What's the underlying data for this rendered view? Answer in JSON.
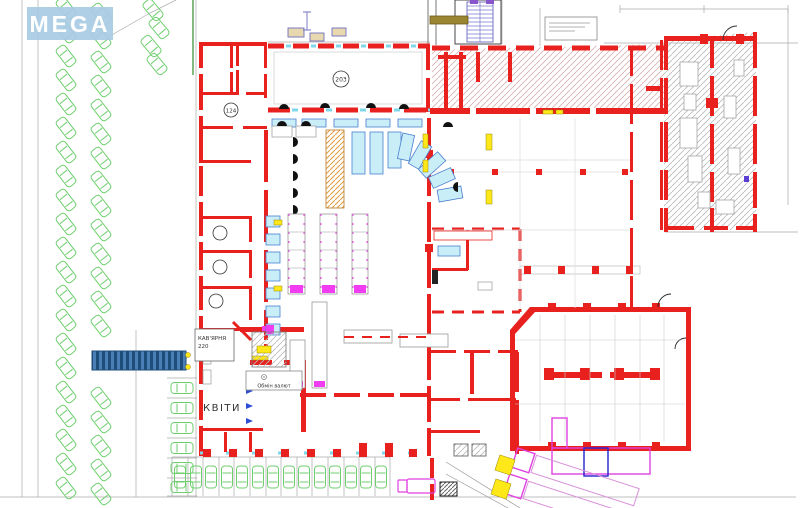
{
  "watermark": {
    "text": "MEGA"
  },
  "labels": {
    "hall_number": "203",
    "room_number": "124",
    "cafe_line1": "КАВ'ЯРНЯ",
    "cafe_line2": "220",
    "flowers": "КВІТИ",
    "currency_exchange": "Обмін валют"
  },
  "colors": {
    "wall_red": "#e8211f",
    "glazing_cyan": "#7fd8ea",
    "car_green": "#6fcf6f",
    "fixture_cyan": "#c9eef7",
    "fixture_blue": "#4a7fd0",
    "gondola_magenta": "#f23cf2",
    "shelf_orange": "#e09a40",
    "marker_yellow": "#ffe81a",
    "truck_magenta": "#e040e0",
    "travelator_blue": "#3f74ad",
    "watermark_blue": "#a9cbe4",
    "hatch_gray": "#b9b9b9",
    "hatch_warm": "#d8b4b4"
  }
}
